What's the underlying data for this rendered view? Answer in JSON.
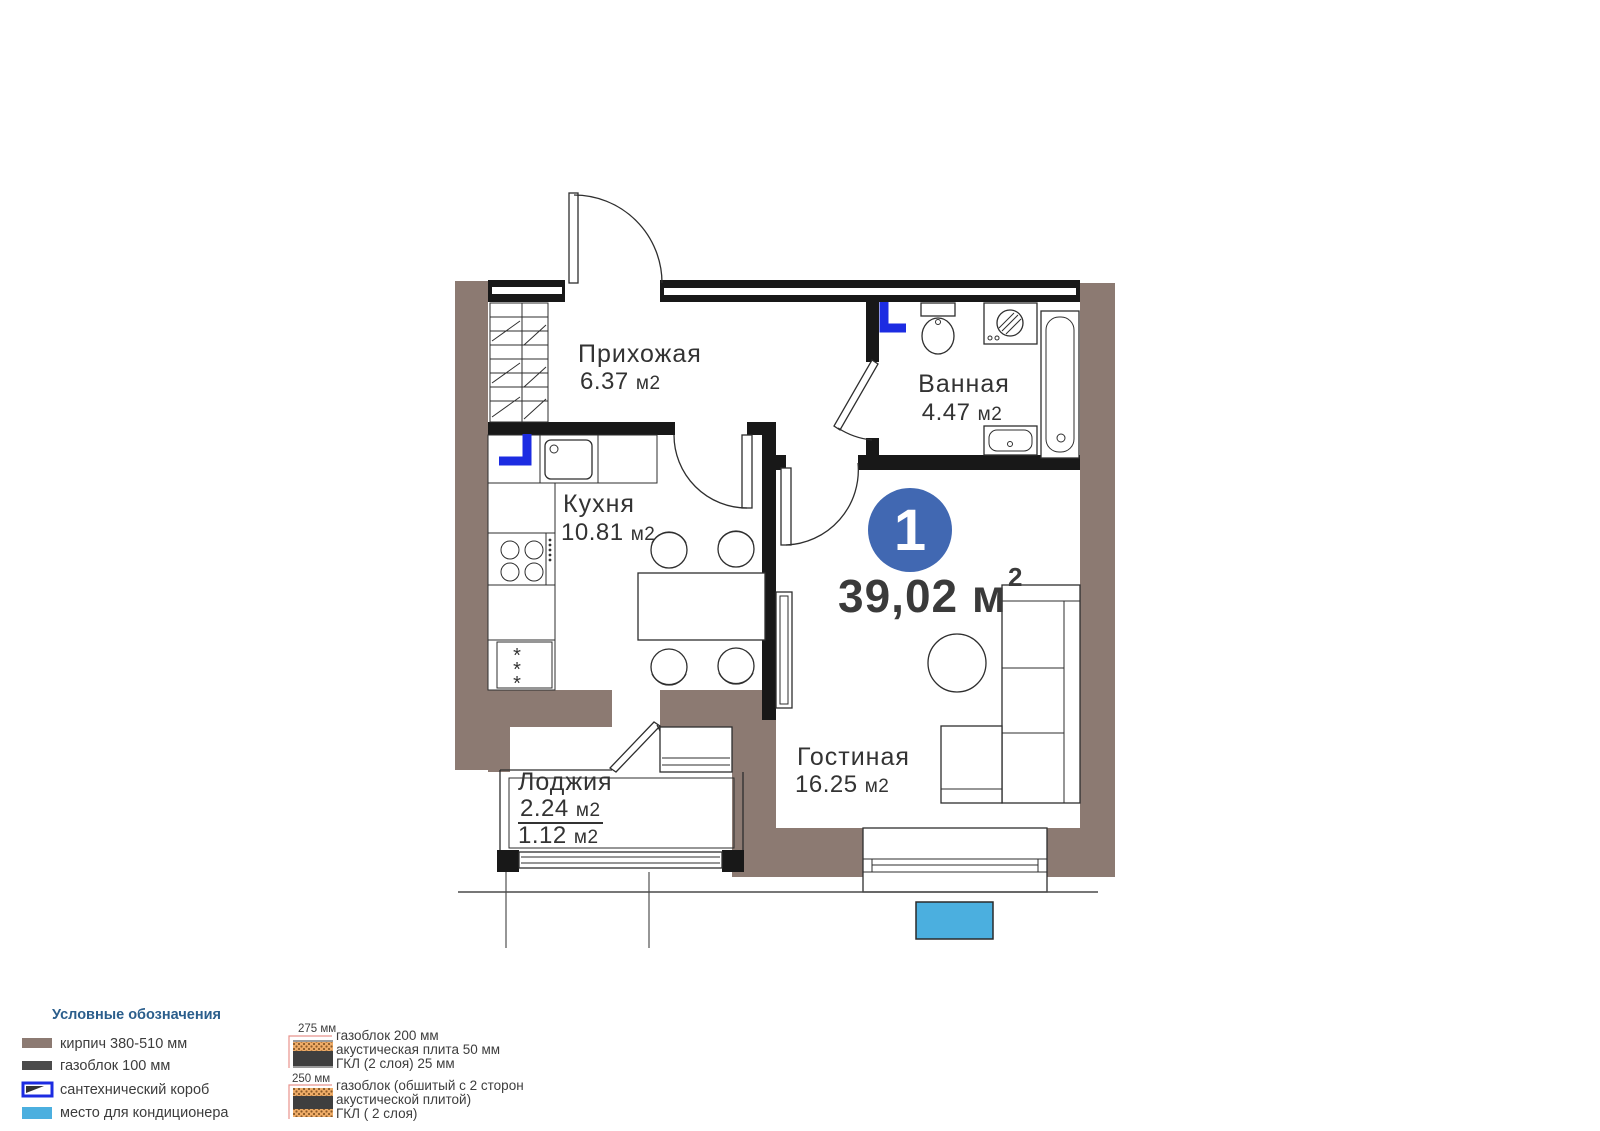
{
  "colors": {
    "brick_brown": "#8c7a72",
    "wall_black": "#181818",
    "plumbing_blue": "#1c2ce2",
    "ac_blue": "#4bafdf",
    "badge_blue": "#4168b2",
    "gasblock_gray": "#4b4b4b",
    "acoustic_orange": "#efa95f",
    "dim_pink": "#e8938d",
    "swatch_dark": "#3f3f3f",
    "legend_header_blue": "#2b5e8c"
  },
  "plan": {
    "badge_number": "1",
    "total_area": "39,02 м",
    "total_area_sup": "2",
    "rooms": {
      "hallway": {
        "name": "Прихожая",
        "area": "6.37",
        "unit": "м2"
      },
      "bathroom": {
        "name": "Ванная",
        "area": "4.47",
        "unit": "м2"
      },
      "kitchen": {
        "name": "Кухня",
        "area": "10.81",
        "unit": "м2"
      },
      "living": {
        "name": "Гостиная",
        "area": "16.25",
        "unit": "м2"
      },
      "loggia": {
        "name": "Лоджия",
        "area_full": "2.24",
        "area_half": "1.12",
        "unit": "м2"
      }
    }
  },
  "legend": {
    "title": "Условные обозначения",
    "items": [
      {
        "label": "кирпич 380-510 мм"
      },
      {
        "label": "газоблок 100 мм"
      },
      {
        "label": "сантехнический короб"
      },
      {
        "label": "место для кондиционера"
      }
    ]
  },
  "wall_legend": {
    "first": {
      "dim": "275 мм",
      "line1": "газоблок 200 мм",
      "line2": "акустическая плита 50 мм",
      "line3": "ГКЛ (2 слоя) 25 мм"
    },
    "second": {
      "dim": "250 мм",
      "line1": "газоблок (обшитый с 2 сторон",
      "line2": "акустической плитой)",
      "line3": "ГКЛ ( 2 слоя)"
    }
  }
}
